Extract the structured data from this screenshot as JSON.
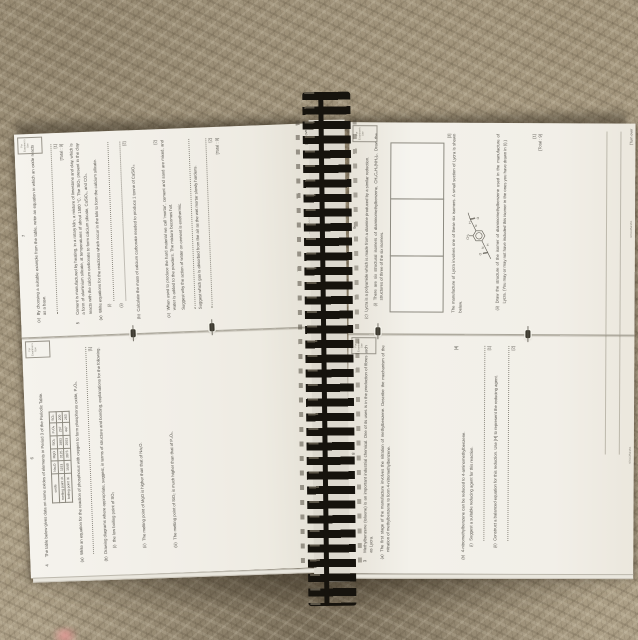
{
  "pages": {
    "left_top": {
      "number": "7",
      "examiner_note": "For Examiner's Use",
      "c_label": "(c)",
      "c_text": "By choosing a suitable example from the table, write an equation in which an oxide reacts as a base.",
      "c_mark": "[1]",
      "q4_total": "[Total : 9]",
      "q5_number": "5",
      "q5_intro": "Cement is manufactured by heating, in a rotary kiln, a mixture of limestone and clay, which is a form of aluminium silicate, at temperatures of about 1500 °C. The SiO₂ present in the clay reacts with the calcium carbonate to form calcium silicate, CaSiO₃, and CO₂.",
      "a_label": "(a)",
      "a_text": "Write equations for the reactions which occur in the kiln to form the calcium silicate.",
      "a_i_label": "(i)",
      "a_ii_label": "(ii)",
      "a_mark": "[2]",
      "b_label": "(b)",
      "b_text": "Calculate the mass of calcium carbonate needed to produce 1 tonne of CaSiO₃.",
      "b_mark": "[2]",
      "c2_label": "(c)",
      "c2_text": "When used to produce the hard material we call 'mortar', cement and sand are mixed, and water is added to the powders. The mixture becomes hot.",
      "c2_q1": "Suggest why the action of water on cement is exothermic.",
      "c2_q2": "Suggest which gas is absorbed from the air as the wet mortar slowly hardens.",
      "c2_mark": "[2]",
      "q5_total": "[Total : 9]",
      "footer_code": "9701/2/O/N/02",
      "turn_over": "[Turn over"
    },
    "left_bottom": {
      "number": "6",
      "examiner_note": "For Examiner's Use",
      "q4_number": "4",
      "q4_intro": "The table below gives data on some oxides of elements in Period 3 of the Periodic Table.",
      "table": {
        "col_headers": [
          "oxide",
          "Na₂O",
          "MgO",
          "SiO₂",
          "P₄O₆",
          "SO₂"
        ],
        "rows": [
          {
            "label": "melting point /K",
            "values": [
              "1193",
              "3125",
              "1883",
              "297",
              "200"
            ]
          },
          {
            "label": "boiling point /K",
            "values": [
              "1548",
              "3873",
              "2503",
              "447",
              "263"
            ]
          }
        ]
      },
      "a_label": "(a)",
      "a_text": "Write an equation for the reaction of phosphorus with oxygen to form phosphorus oxide, P₄O₆.",
      "a_mark": "[1]",
      "b_label": "(b)",
      "b_text": "Drawing diagrams where appropriate, suggest, in terms of structure and bonding, explanations for the following.",
      "b_i_label": "(i)",
      "b_i_text": "the low boiling point of SO₂",
      "b_ii_label": "(ii)",
      "b_ii_text": "The melting point of MgO is higher than that of Na₂O.",
      "b_iii_label": "(iii)",
      "b_iii_text": "The melting point of SiO₂ is much higher than that of P₄O₆.",
      "footer_code": "9701/2/O/N/02"
    },
    "right_top": {
      "number": "9",
      "examiner_note": "For Examiner's Use",
      "c_label": "(c)",
      "c_text": "Lycra is a polyamide which is made from a diamine produced by a similar reduction.",
      "c_i_label": "(i)",
      "c_i_text": "There are six structural isomers of diaminomethylbenzene, CH₃C₆H₃(NH₂)₂. Draw the structures of three of the six isomers.",
      "c_i_mark": "[3]",
      "between_text": "The manufacture of Lycra involves one of these six isomers. A small section of Lycra is shown below.",
      "molecule": {
        "o1": "O",
        "n1": "N",
        "h1": "H",
        "ch3": "CH₃",
        "o2": "O",
        "n2": "N",
        "h2": "H"
      },
      "c_ii_label": "(ii)",
      "c_ii_text": "Draw the structure of the isomer of diaminomethylbenzene used in the manufacture of Lycra. (You may or may not have included this isomer in the ones you have drawn in (i).)",
      "c_ii_mark": "[1]",
      "total": "[Total : 9]",
      "footer_code": "9701/2/M/J/04",
      "turn_over": "[Turn over"
    },
    "right_bottom": {
      "number": "8",
      "examiner_note": "For Examiner's Use",
      "q_number": "3",
      "intro": "Methylbenzene (toluene) is an important industrial chemical. One of its uses is in the production of fibres such as Lycra.",
      "a_label": "(a)",
      "a_text": "The first stage of the manufacture involves the nitration of methylbenzene. Describe the mechanism of the nitration of methylbenzene to form 4-nitromethylbenzene.",
      "a_mark": "[4]",
      "b_label": "(b)",
      "b_text": "4-nitromethylbenzene can be reduced to 4-aminomethylbenzene.",
      "b_i_label": "(i)",
      "b_i_text": "Suggest a suitable reducing agent for this reaction.",
      "b_i_mark": "[1]",
      "b_ii_label": "(ii)",
      "b_ii_text": "Construct a balanced equation for this reduction. Use [H] to represent the reducing agent.",
      "b_ii_mark": "[2]",
      "footer_code": "9701/2/M/J/04"
    }
  }
}
